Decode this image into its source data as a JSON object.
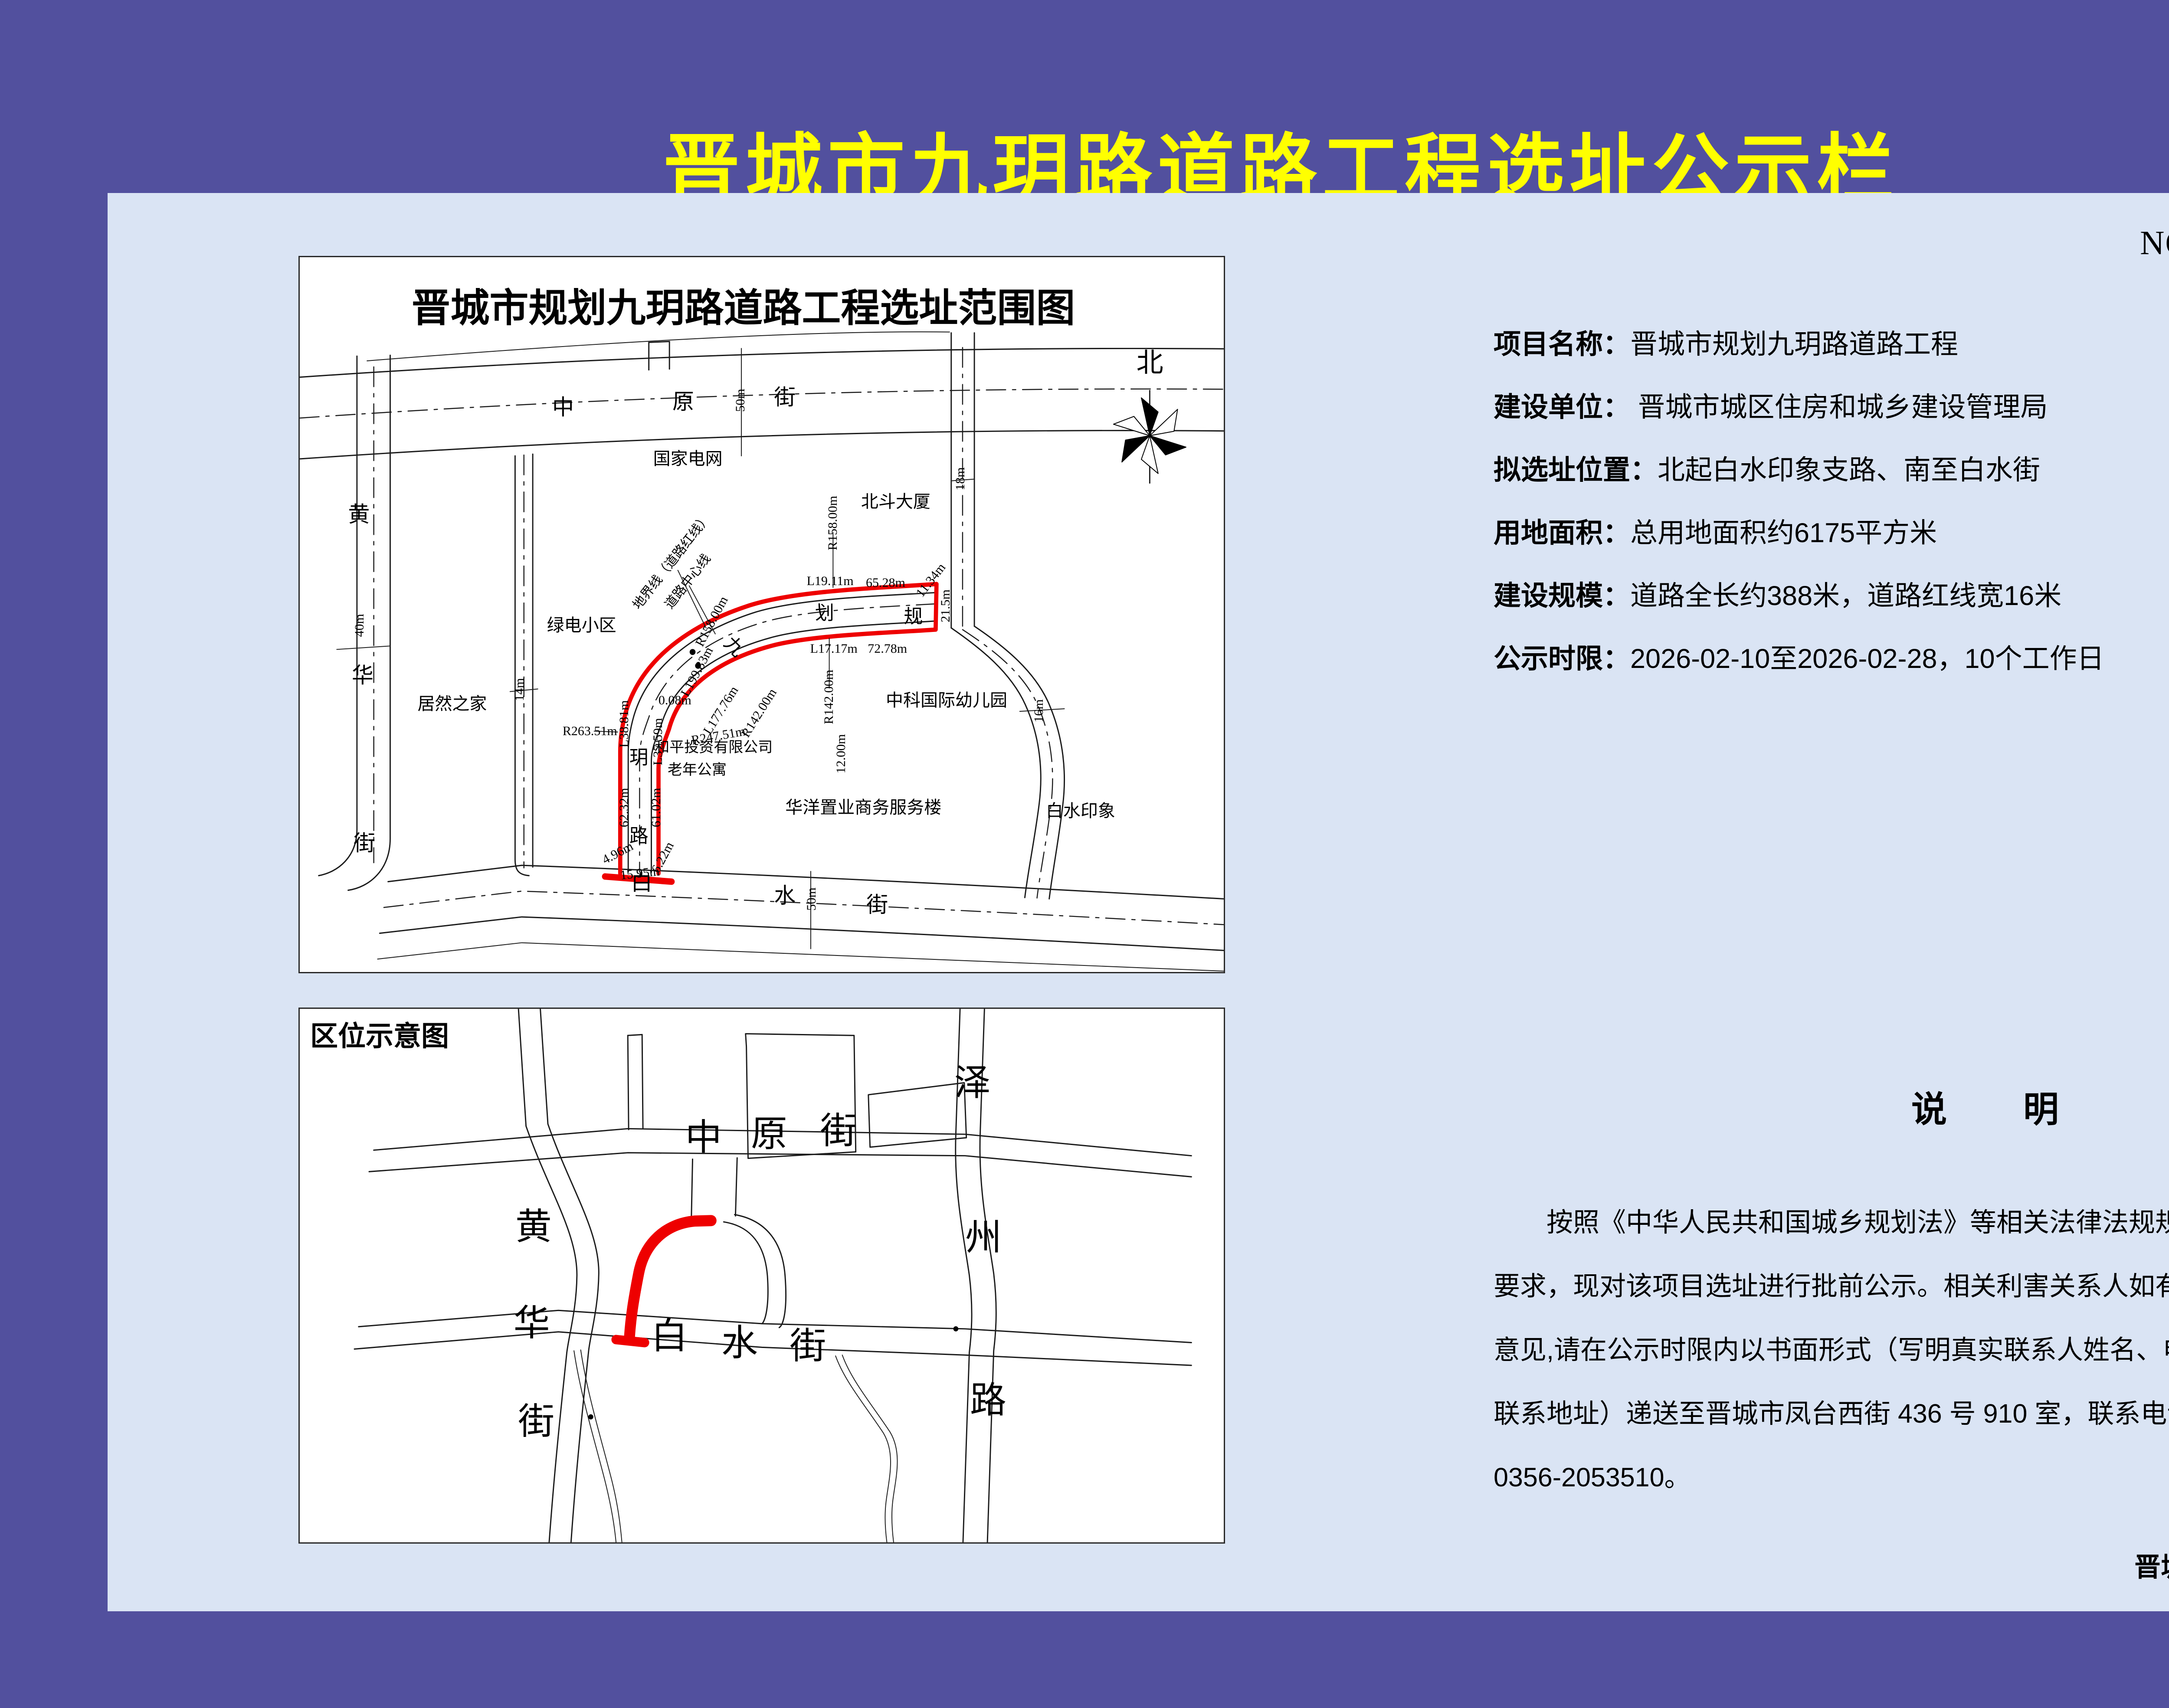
{
  "colors": {
    "background": "#52509E",
    "panel": "#DAE4F4",
    "title_yellow": "#FFFF00",
    "road_red": "#EE0000",
    "ink": "#000000"
  },
  "title": "晋城市九玥路道路工程选址公示栏",
  "doc_no": "NO;选址-2026-JG-07",
  "info": {
    "rows": [
      {
        "label": "项目名称：",
        "value": "晋城市规划九玥路道路工程"
      },
      {
        "label": "建设单位：",
        "value": " 晋城市城区住房和城乡建设管理局"
      },
      {
        "label": "拟选址位置：",
        "value": "北起白水印象支路、南至白水街"
      },
      {
        "label": "用地面积：",
        "value": "总用地面积约6175平方米"
      },
      {
        "label": "建设规模：",
        "value": "道路全长约388米，道路红线宽16米"
      },
      {
        "label": "公示时限：",
        "value": "2026-02-10至2026-02-28，10个工作日"
      }
    ]
  },
  "map1": {
    "labels": [
      {
        "t": "晋城市规划九玥路道路工程选址范围图",
        "x": 48,
        "y": 7.2,
        "fs": 90,
        "b": 1
      },
      {
        "t": "北",
        "x": 92,
        "y": 14.8,
        "fs": 62
      },
      {
        "t": "中",
        "x": 28.5,
        "y": 21,
        "fs": 50
      },
      {
        "t": "原",
        "x": 41.5,
        "y": 20.2,
        "fs": 50
      },
      {
        "t": "街",
        "x": 52.5,
        "y": 19.6,
        "fs": 50
      },
      {
        "t": "50m",
        "x": 47.7,
        "y": 20,
        "v": 1
      },
      {
        "t": "黄",
        "x": 6.4,
        "y": 36,
        "fs": 50
      },
      {
        "t": "华",
        "x": 6.8,
        "y": 58.5,
        "fs": 50
      },
      {
        "t": "街",
        "x": 7,
        "y": 82,
        "fs": 50
      },
      {
        "t": "40m",
        "x": 6.5,
        "y": 51.5,
        "v": 1
      },
      {
        "t": "白",
        "x": 37,
        "y": 87.5,
        "fs": 50
      },
      {
        "t": "水",
        "x": 52.5,
        "y": 89.3,
        "fs": 50
      },
      {
        "t": "街",
        "x": 62.5,
        "y": 90.6,
        "fs": 50
      },
      {
        "t": "50m",
        "x": 55.4,
        "y": 89.8,
        "v": 1
      },
      {
        "t": "14m",
        "x": 23.8,
        "y": 60.5,
        "v": 1
      },
      {
        "t": "18m",
        "x": 71.5,
        "y": 31,
        "v": 1
      },
      {
        "t": "16m",
        "x": 80,
        "y": 63.5,
        "v": 1
      },
      {
        "t": "国家电网",
        "x": 42,
        "y": 28.2,
        "fs": 40
      },
      {
        "t": "北斗大厦",
        "x": 64.5,
        "y": 34.2,
        "fs": 40
      },
      {
        "t": "绿电小区",
        "x": 30.5,
        "y": 51.5,
        "fs": 40
      },
      {
        "t": "居然之家",
        "x": 16.5,
        "y": 62.5,
        "fs": 40
      },
      {
        "t": "中科国际幼儿园",
        "x": 70,
        "y": 62,
        "fs": 40
      },
      {
        "t": "华洋置业商务服务楼",
        "x": 61,
        "y": 77,
        "fs": 40
      },
      {
        "t": "白水印象",
        "x": 84.5,
        "y": 77.5,
        "fs": 40
      },
      {
        "t": "和平投资有限公司",
        "x": 44.8,
        "y": 68.6,
        "fs": 34
      },
      {
        "t": "老年公寓",
        "x": 43,
        "y": 71.8,
        "fs": 34
      },
      {
        "t": "划",
        "x": 56.8,
        "y": 49.8,
        "fs": 44
      },
      {
        "t": "规",
        "x": 66.4,
        "y": 50.3,
        "fs": 44
      },
      {
        "t": "九",
        "x": 47,
        "y": 54.5,
        "fs": 44,
        "r": 45
      },
      {
        "t": "玥",
        "x": 36.7,
        "y": 70,
        "fs": 44
      },
      {
        "t": "路",
        "x": 36.7,
        "y": 81,
        "fs": 44
      },
      {
        "t": "R158.00m",
        "x": 57.7,
        "y": 37.2,
        "v": 1
      },
      {
        "t": "L19.11m",
        "x": 57.4,
        "y": 45.3
      },
      {
        "t": "65.28m",
        "x": 63.4,
        "y": 45.6
      },
      {
        "t": "11.34m",
        "x": 68.3,
        "y": 45.2,
        "r": -52
      },
      {
        "t": "21.5m",
        "x": 69.9,
        "y": 48.8,
        "v": 1
      },
      {
        "t": "L17.17m",
        "x": 57.8,
        "y": 54.8
      },
      {
        "t": "72.78m",
        "x": 63.6,
        "y": 54.8
      },
      {
        "t": "R142.00m",
        "x": 57.3,
        "y": 61.5,
        "v": 1
      },
      {
        "t": "12.00m",
        "x": 58.6,
        "y": 69.5,
        "v": 1
      },
      {
        "t": "地界线（道路红线）",
        "x": 40.3,
        "y": 42.6,
        "r": -52
      },
      {
        "t": "道路中心线",
        "x": 42,
        "y": 45.4,
        "r": -52
      },
      {
        "t": "R158.00m",
        "x": 44.6,
        "y": 51,
        "r": -62
      },
      {
        "t": "L199.83m",
        "x": 43,
        "y": 58,
        "r": -62
      },
      {
        "t": "L177.76m",
        "x": 45.6,
        "y": 63.4,
        "r": -58
      },
      {
        "t": "R142.00m",
        "x": 49.7,
        "y": 63.8,
        "r": -58
      },
      {
        "t": "0.08m",
        "x": 40.6,
        "y": 62
      },
      {
        "t": "R263.51m",
        "x": 31.4,
        "y": 66.3
      },
      {
        "t": "L38.81m",
        "x": 35.1,
        "y": 65.3,
        "v": 1
      },
      {
        "t": "L37.59m",
        "x": 38.8,
        "y": 67.8,
        "v": 1
      },
      {
        "t": "R247.51m",
        "x": 45.3,
        "y": 67,
        "r": -10
      },
      {
        "t": "62.32m",
        "x": 35.1,
        "y": 77,
        "v": 1
      },
      {
        "t": "61.02m",
        "x": 38.6,
        "y": 77,
        "v": 1
      },
      {
        "t": "4.96m",
        "x": 34.4,
        "y": 83.4,
        "r": -28
      },
      {
        "t": "6.22m",
        "x": 39.3,
        "y": 84,
        "r": -62
      },
      {
        "t": "15.95m",
        "x": 36.8,
        "y": 86.2,
        "r": -6
      }
    ]
  },
  "map2": {
    "corner_label": "区位示意图",
    "labels": [
      {
        "t": "黄",
        "x": 25.3,
        "y": 41,
        "fs": 84
      },
      {
        "t": "华",
        "x": 25.1,
        "y": 59,
        "fs": 84
      },
      {
        "t": "街",
        "x": 25.6,
        "y": 77.5,
        "fs": 84
      },
      {
        "t": "中",
        "x": 43.7,
        "y": 24.2,
        "fs": 84
      },
      {
        "t": "原",
        "x": 50.8,
        "y": 23.6,
        "fs": 84
      },
      {
        "t": "街",
        "x": 58.3,
        "y": 23,
        "fs": 84
      },
      {
        "t": "泽",
        "x": 72.8,
        "y": 14,
        "fs": 84
      },
      {
        "t": "州",
        "x": 74,
        "y": 43,
        "fs": 84
      },
      {
        "t": "路",
        "x": 74.5,
        "y": 73.5,
        "fs": 84
      },
      {
        "t": "白",
        "x": 40,
        "y": 61.5,
        "fs": 84
      },
      {
        "t": "水",
        "x": 47.6,
        "y": 62.8,
        "fs": 84
      },
      {
        "t": "街",
        "x": 55,
        "y": 63.3,
        "fs": 84
      }
    ]
  },
  "notice": {
    "title": "说　　明",
    "lines": [
      "按照《中华人民共和国城乡规划法》等相关法律法规规定",
      "要求，现对该项目选址进行批前公示。相关利害关系人如有不同",
      "意见,请在公示时限内以书面形式（写明真实联系人姓名、电话、",
      "联系地址）递送至晋城市凤台西街 436 号 910 室，联系电话：",
      "0356-2053510。"
    ]
  },
  "footer": "晋城市规划和自然资源局监制"
}
